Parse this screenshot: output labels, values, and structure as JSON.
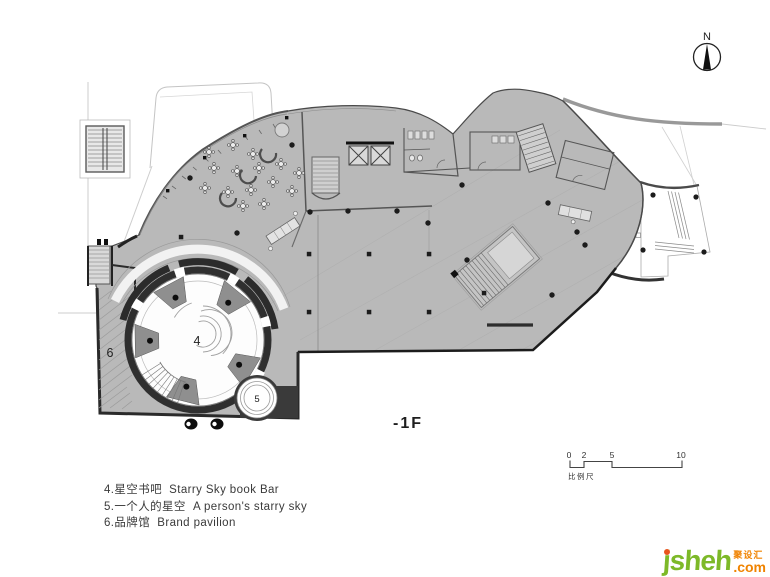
{
  "meta": {
    "north_label": "N",
    "floor_label": "-1F"
  },
  "plan": {
    "room_labels": [
      {
        "num": "4"
      },
      {
        "num": "5"
      },
      {
        "num": "6"
      }
    ]
  },
  "legend": {
    "items": [
      {
        "text": "4.星空书吧  Starry Sky book Bar"
      },
      {
        "text": "5.一个人的星空  A person's starry sky"
      },
      {
        "text": "6.品牌馆  Brand pavilion"
      }
    ]
  },
  "scalebar": {
    "ticks": [
      "0",
      "2",
      "5",
      "10"
    ],
    "label": "比例尺"
  },
  "watermark": {
    "name": "jsheh",
    "zh": "聚设汇",
    "tld": ".com"
  },
  "colors": {
    "floor_fill": "#b9b9b9",
    "wall_dark": "#2a2a2a",
    "outline": "#4a4a4a",
    "brand_green": "#7db928",
    "brand_orange": "#f08300"
  }
}
